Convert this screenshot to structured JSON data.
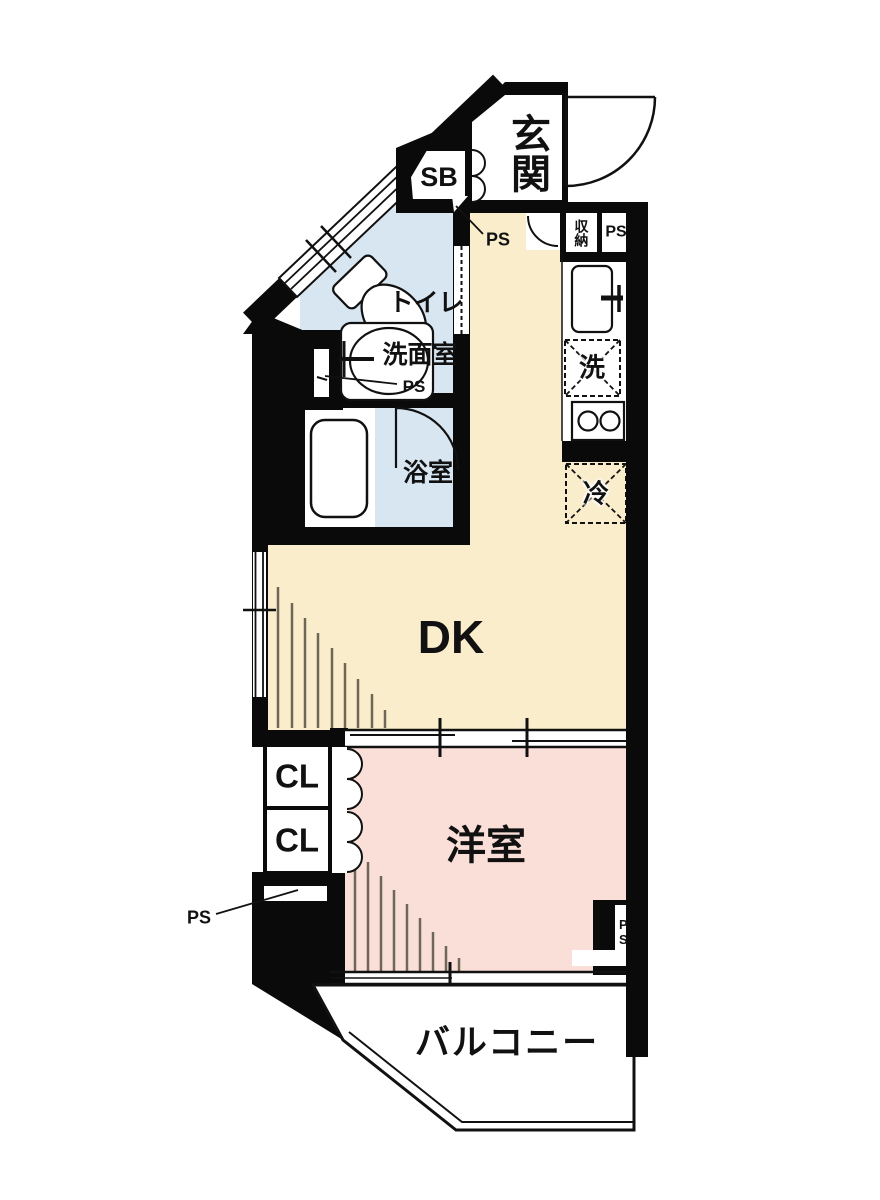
{
  "floor_plan": {
    "rooms": {
      "entrance": {
        "label": "玄関"
      },
      "shoe_box": {
        "label": "SB"
      },
      "toilet": {
        "label": "トイレ"
      },
      "washroom": {
        "label": "洗面室"
      },
      "bathroom": {
        "label": "浴室"
      },
      "dining_kitchen": {
        "label": "DK"
      },
      "western_room": {
        "label": "洋室"
      },
      "closet_1": {
        "label": "CL"
      },
      "closet_2": {
        "label": "CL"
      },
      "storage": {
        "label": "収納"
      },
      "balcony": {
        "label": "バルコニー"
      }
    },
    "equipment": {
      "washer_space": {
        "label": "洗"
      },
      "fridge_space": {
        "label": "冷"
      }
    },
    "pipe_spaces": {
      "ps_top_right": "PS",
      "ps_hall": "PS",
      "ps_washroom": "PS",
      "ps_left": "PS",
      "ps_notch": "PS"
    },
    "colors": {
      "floor_cream": "#FAEDCB",
      "floor_pink": "#FADFD8",
      "floor_blue": "#D8E6F1",
      "wall_black": "#0A0A0A",
      "hatch_line": "#6E6758"
    }
  }
}
